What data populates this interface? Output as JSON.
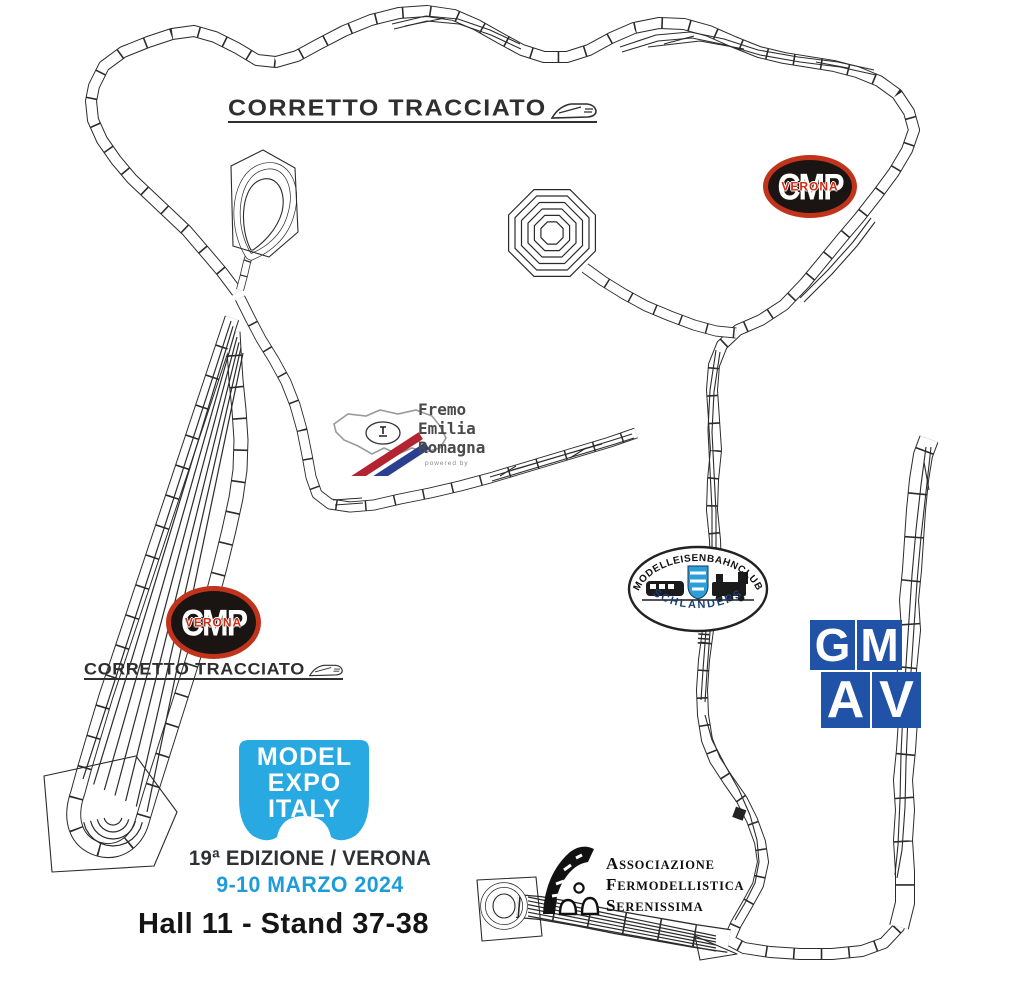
{
  "branding": {
    "corretto_tracciato": {
      "text": "CORRETTO TRACCIATO"
    },
    "cmp_verona": {
      "letters": "CMP",
      "city": "VERONA"
    },
    "fremo": {
      "line1": "Fremo",
      "line2": "Emilia",
      "line3": "Romagna",
      "subtext": "powered by"
    },
    "schlanders": {
      "arc_top": "MODELLEISENBAHNCLUB",
      "arc_bottom": "SCHLANDERS"
    },
    "gmav": {
      "l1": "G",
      "l2": "M",
      "l3": "A",
      "l4": "V"
    },
    "model_expo": {
      "line1": "MODEL",
      "line2": "EXPO",
      "line3": "ITALY"
    },
    "serenissima": {
      "line1": "Associazione",
      "line2": "Fermodellistica",
      "line3": "Serenissima"
    }
  },
  "event": {
    "edition": "19ª EDIZIONE / VERONA",
    "date": "9-10 MARZO 2024",
    "location": "Hall 11 - Stand 37-38"
  },
  "colors": {
    "track": "#2b2b2b",
    "mei_blue": "#29a9e1",
    "date_blue": "#1e9cd9",
    "gmav_blue": "#2052a8",
    "cmp_red": "#c2331c",
    "cmp_dark": "#1a1512",
    "fremo_red": "#b32431",
    "fremo_blue": "#2a3f8f",
    "shield_blue": "#2d9fd8",
    "text_dark": "#2e3033"
  }
}
